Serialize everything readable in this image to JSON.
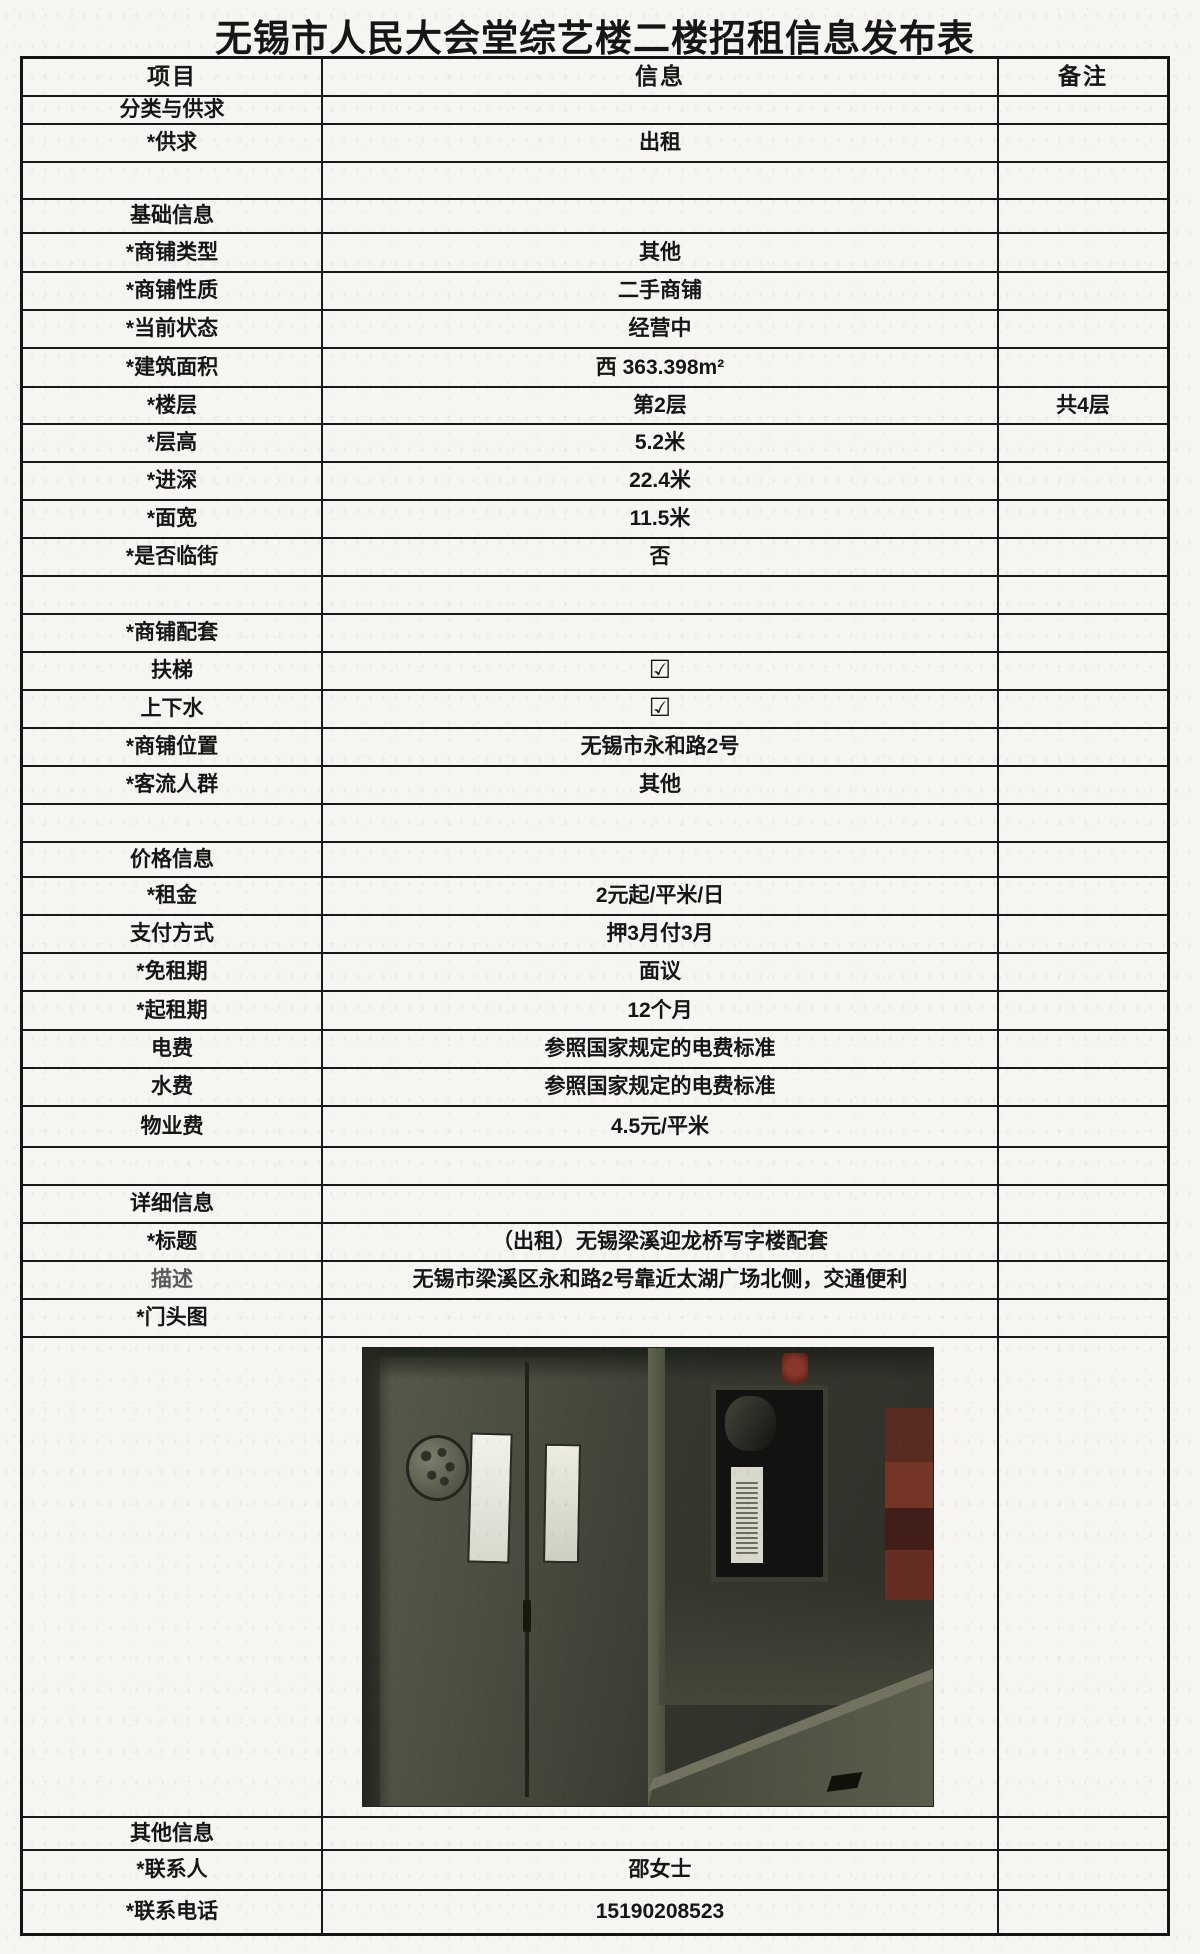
{
  "page": {
    "title": "无锡市人民大会堂综艺楼二楼招租信息发布表"
  },
  "table": {
    "headers": [
      "项目",
      "信息",
      "备注"
    ],
    "rows": [
      {
        "kind": "normal",
        "label": "分类与供求",
        "value": "",
        "note": ""
      },
      {
        "kind": "normal",
        "label": "*供求",
        "value": "出租",
        "note": ""
      },
      {
        "kind": "empty",
        "label": "",
        "value": "",
        "note": ""
      },
      {
        "kind": "normal",
        "label": "基础信息",
        "value": "",
        "note": ""
      },
      {
        "kind": "normal",
        "label": "*商铺类型",
        "value": "其他",
        "note": ""
      },
      {
        "kind": "normal",
        "label": "*商铺性质",
        "value": "二手商铺",
        "note": ""
      },
      {
        "kind": "normal",
        "label": "*当前状态",
        "value": "经营中",
        "note": ""
      },
      {
        "kind": "normal",
        "label": "*建筑面积",
        "value": "西 363.398m²",
        "note": ""
      },
      {
        "kind": "normal",
        "label": "*楼层",
        "value": "第2层",
        "note": "共4层"
      },
      {
        "kind": "normal",
        "label": "*层高",
        "value": "5.2米",
        "note": ""
      },
      {
        "kind": "normal",
        "label": "*进深",
        "value": "22.4米",
        "note": ""
      },
      {
        "kind": "normal",
        "label": "*面宽",
        "value": "11.5米",
        "note": ""
      },
      {
        "kind": "normal",
        "label": "*是否临街",
        "value": "否",
        "note": ""
      },
      {
        "kind": "empty",
        "label": "",
        "value": "",
        "note": ""
      },
      {
        "kind": "normal",
        "label": "*商铺配套",
        "value": "",
        "note": ""
      },
      {
        "kind": "checkbox",
        "label": "扶梯",
        "value": "☑",
        "note": ""
      },
      {
        "kind": "checkbox",
        "label": "上下水",
        "value": "☑",
        "note": ""
      },
      {
        "kind": "normal",
        "label": "*商铺位置",
        "value": "无锡市永和路2号",
        "note": ""
      },
      {
        "kind": "normal",
        "label": "*客流人群",
        "value": "其他",
        "note": ""
      },
      {
        "kind": "empty",
        "label": "",
        "value": "",
        "note": ""
      },
      {
        "kind": "normal",
        "label": "价格信息",
        "value": "",
        "note": ""
      },
      {
        "kind": "normal",
        "label": "*租金",
        "value": "2元起/平米/日",
        "note": ""
      },
      {
        "kind": "normal",
        "label": "支付方式",
        "value": "押3月付3月",
        "note": ""
      },
      {
        "kind": "normal",
        "label": "*免租期",
        "value": "面议",
        "note": ""
      },
      {
        "kind": "normal",
        "label": "*起租期",
        "value": "12个月",
        "note": ""
      },
      {
        "kind": "normal",
        "label": "电费",
        "value": "参照国家规定的电费标准",
        "note": ""
      },
      {
        "kind": "normal",
        "label": "水费",
        "value": "参照国家规定的电费标准",
        "note": ""
      },
      {
        "kind": "normal",
        "label": "物业费",
        "value": "4.5元/平米",
        "note": ""
      },
      {
        "kind": "empty",
        "label": "",
        "value": "",
        "note": ""
      },
      {
        "kind": "normal",
        "label": "详细信息",
        "value": "",
        "note": ""
      },
      {
        "kind": "normal",
        "label": "*标题",
        "value": "（出租）无锡梁溪迎龙桥写字楼配套",
        "note": ""
      },
      {
        "kind": "normal",
        "label": "描述",
        "value": "无锡市梁溪区永和路2号靠近太湖广场北侧，交通便利",
        "note": "",
        "muted": true
      },
      {
        "kind": "normal",
        "label": "*门头图",
        "value": "",
        "note": ""
      },
      {
        "kind": "photo",
        "label": "",
        "value": "",
        "note": ""
      },
      {
        "kind": "normal",
        "label": "其他信息",
        "value": "",
        "note": ""
      },
      {
        "kind": "normal",
        "label": "*联系人",
        "value": "邵女士",
        "note": ""
      },
      {
        "kind": "normal",
        "label": "*联系电话",
        "value": "15190208523",
        "note": ""
      }
    ]
  }
}
